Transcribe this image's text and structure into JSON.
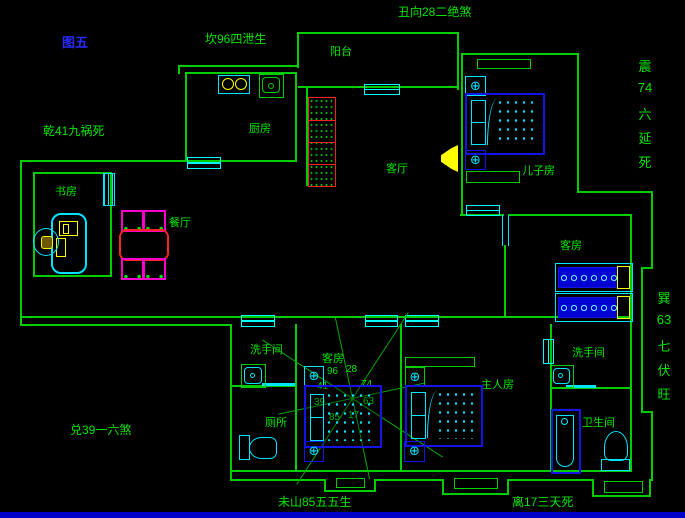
{
  "figure_label": "图五",
  "annotations": {
    "top": "丑向28二绝煞",
    "kan": "坎96四泄生",
    "qian": "乾41九祸死",
    "dui": "兑39一六煞",
    "wei": "未山85五五生",
    "li": "离17三天死",
    "zhen": [
      "震",
      "74",
      "六",
      "延",
      "死"
    ],
    "xun": [
      "巽",
      "63",
      "七",
      "伏",
      "旺"
    ]
  },
  "rooms": {
    "balcony": "阳台",
    "kitchen": "厨房",
    "living": "客厅",
    "son": "儿子房",
    "study": "书房",
    "dining": "餐厅",
    "guest_right": "客房",
    "guest_bottom": "客房",
    "wash_left": "洗手间",
    "toilet": "厕所",
    "master": "主人房",
    "wash_right": "洗手间",
    "bath": "卫生间"
  },
  "compass_numbers": [
    "96",
    "28",
    "41",
    "74",
    "39",
    "63",
    "85",
    "17"
  ],
  "icons": {
    "nightstand_target": "⊕"
  },
  "colors": {
    "background": "#000000",
    "wall": "#00cd00",
    "text": "#00e600",
    "figure_label": "#2b2bff",
    "window": "#00ffff",
    "bed_blue": "#1414e6",
    "accent_red": "#ff2020",
    "accent_magenta": "#ff00cc",
    "accent_yellow": "#ffff00",
    "bottom_bar": "#0000c8"
  }
}
